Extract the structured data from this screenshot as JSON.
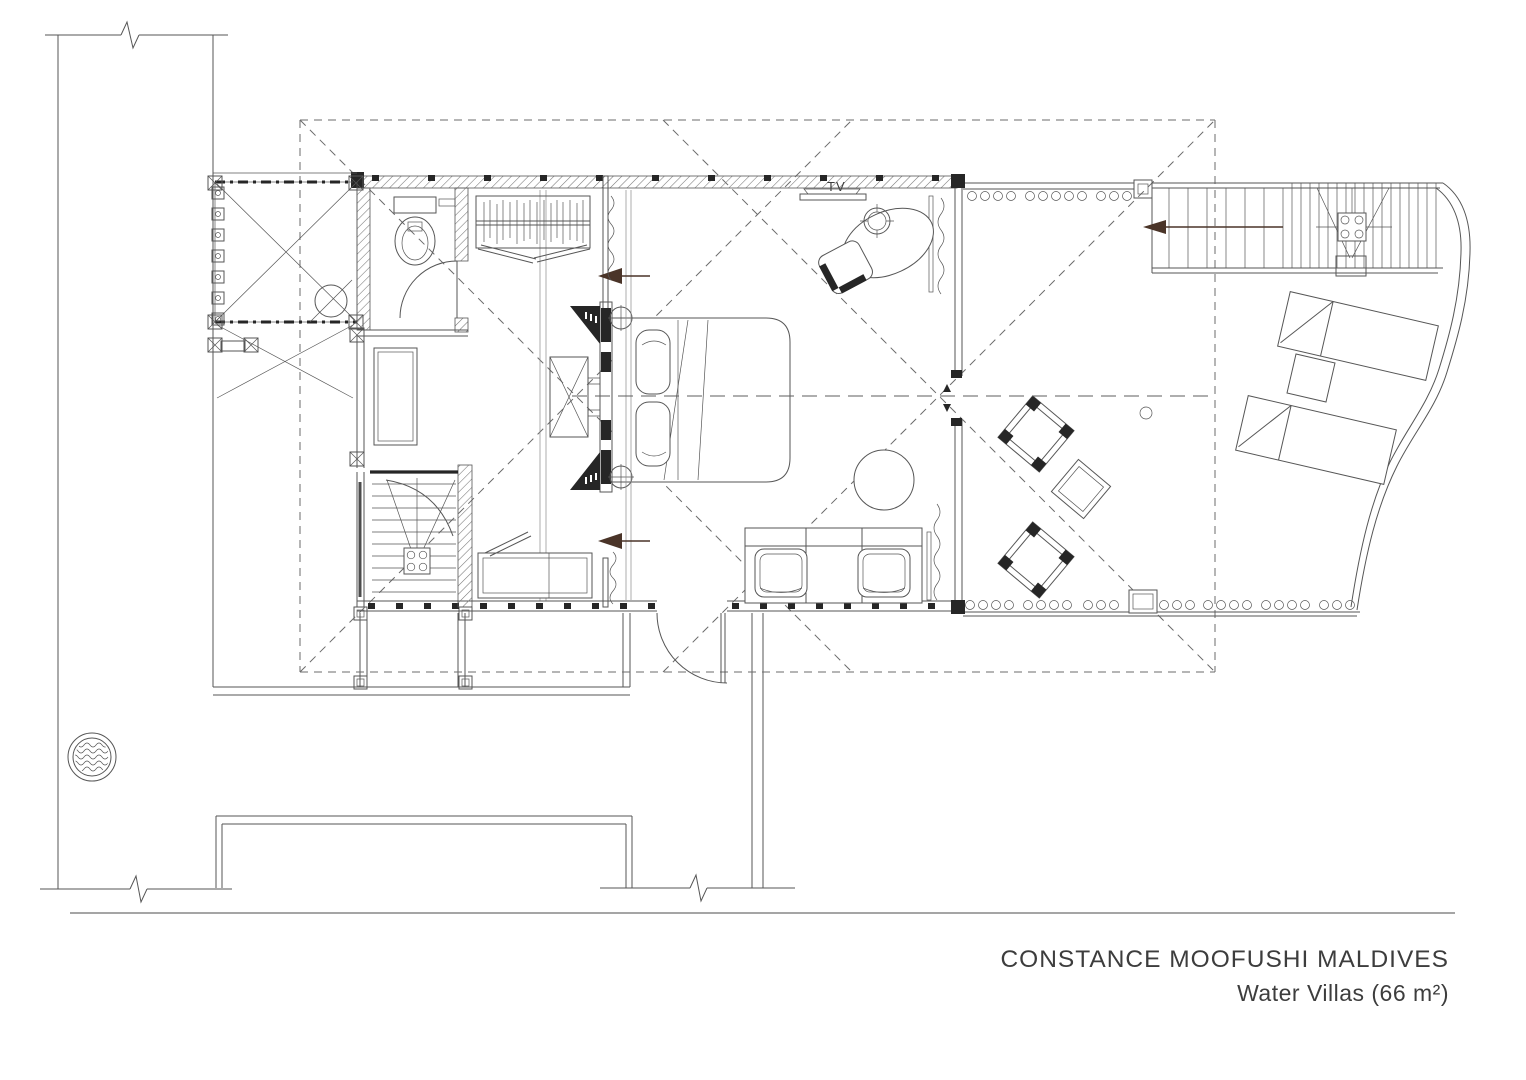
{
  "title_block": {
    "line1": "CONSTANCE MOOFUSHI MALDIVES",
    "line2": "Water Villas (66 m²)"
  },
  "labels": {
    "tv": "TV"
  },
  "colors": {
    "background": "#ffffff",
    "ink": "#565656",
    "wall_dark": "#262626",
    "title": "#3d3d3d",
    "faint": "#8a8a8a"
  }
}
